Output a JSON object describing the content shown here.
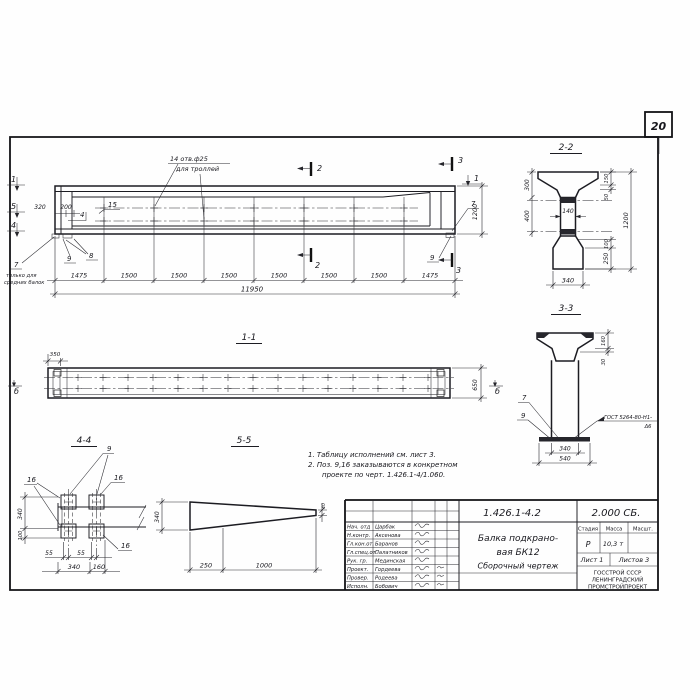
{
  "sheet": {
    "number": "20"
  },
  "main_view": {
    "hole_note1": "14 отв.ф25",
    "hole_note2": "для троллей",
    "mark1": "1",
    "mark5": "5",
    "mark4": "4",
    "mark2": "2",
    "mark3": "3",
    "pos4": "4",
    "pos15": "15",
    "pos7": "7",
    "pos8": "8",
    "pos9": "9",
    "end_note_pos": "7",
    "end_note1": "только для",
    "end_note2": "средних балок",
    "dim320": "320",
    "dim200": "200",
    "dim1200": "1200",
    "segments": [
      "1475",
      "1500",
      "1500",
      "1500",
      "1500",
      "1500",
      "1500",
      "1475"
    ],
    "total": "11950"
  },
  "section22": {
    "title": "2-2",
    "d300": "300",
    "d400": "400",
    "d140": "140",
    "d150": "150",
    "d50": "50",
    "d1200": "1200",
    "d100": "100",
    "d250": "250",
    "d340": "340"
  },
  "section33": {
    "title": "3-3",
    "d160": "160",
    "d30": "30",
    "d340": "340",
    "d540": "540",
    "weld1": "ГОСТ 5264-80-Н1-",
    "weld2": "Δ6",
    "pos7": "7",
    "pos9": "9"
  },
  "section11": {
    "title": "1-1",
    "d350": "350",
    "d650": "650",
    "mark": "б"
  },
  "section44": {
    "title": "4-4",
    "pos9": "9",
    "pos16": "16",
    "d340": "340",
    "d100": "100",
    "d55": "55",
    "d340b": "340",
    "d160": "160"
  },
  "section55": {
    "title": "5-5",
    "d340": "340",
    "d40": "40",
    "d250": "250",
    "d1000": "1000"
  },
  "notes": {
    "n1": "1. Таблицу исполнений см. лист 3.",
    "n2": "2. Поз. 9,16 заказываются в конкретном",
    "n3": "проекте по черт. 1.426.1-4/1.060."
  },
  "title_block": {
    "doc_number": "1.426.1-4.2",
    "doc_code": "2.000 СБ.",
    "title1": "Балка подкрано-",
    "title2": "вая БК12",
    "title3": "Сборочный  чертеж",
    "stage_label": "Стадия",
    "mass_label": "Масса",
    "scale_label": "Масшт.",
    "stage": "Р",
    "mass": "10,3 т",
    "sheet_label": "Лист 1",
    "sheets_label": "Листов 3",
    "org1": "ГОССТРОЙ СССР",
    "org2": "ЛЕНИНГРАДСКИЙ",
    "org3": "ПРОМСТРОЙПРОЕКТ",
    "rows": [
      {
        "role": "Нач. отд",
        "name": "Царбак"
      },
      {
        "role": "Н.контр.",
        "name": "Аксенова"
      },
      {
        "role": "Гл.кон.от.",
        "name": "Баранов"
      },
      {
        "role": "Гл.спец.от.",
        "name": "Палатников"
      },
      {
        "role": "Рук. гр.",
        "name": "Мединская"
      },
      {
        "role": "Проект.",
        "name": "Гордеева"
      },
      {
        "role": "Провер.",
        "name": "Родеева"
      },
      {
        "role": "Исполн.",
        "name": "Бобович"
      }
    ]
  }
}
